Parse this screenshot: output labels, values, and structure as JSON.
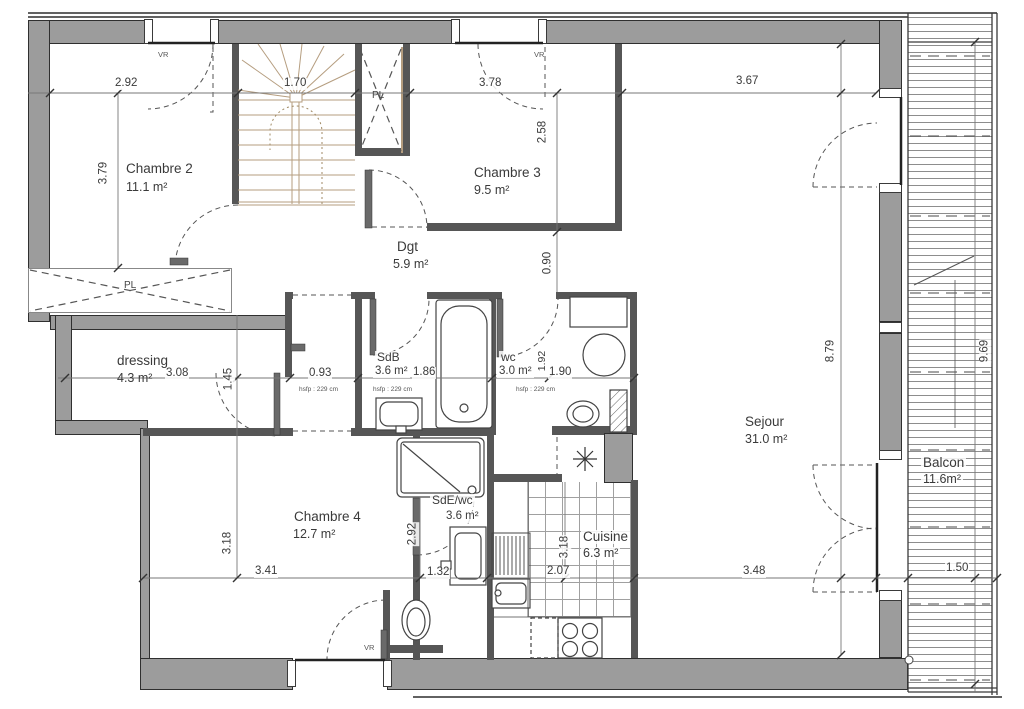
{
  "rooms": {
    "chambre2": {
      "name": "Chambre 2",
      "area": "11.1 m²"
    },
    "chambre3": {
      "name": "Chambre 3",
      "area": "9.5 m²"
    },
    "dgt": {
      "name": "Dgt",
      "area": "5.9 m²"
    },
    "dressing": {
      "name": "dressing",
      "area": "4.3 m²"
    },
    "sdb": {
      "name": "SdB",
      "area": "3.6 m²"
    },
    "wc": {
      "name": "wc",
      "area": "3.0 m²"
    },
    "chambre4": {
      "name": "Chambre 4",
      "area": "12.7 m²"
    },
    "sde": {
      "name": "SdE/wc",
      "area": "3.6 m²"
    },
    "cuisine": {
      "name": "Cuisine",
      "area": "6.3 m²"
    },
    "sejour": {
      "name": "Sejour",
      "area": "31.0 m²"
    },
    "balcon": {
      "name": "Balcon",
      "area": "11.6m²"
    }
  },
  "dims": {
    "chambre2_w": "2.92",
    "stairs_w": "1.70",
    "chambre3_w": "3.78",
    "sejour_w_top": "3.67",
    "chambre2_h": "3.79",
    "chambre3_h": "2.58",
    "dgt_h": "0.90",
    "dressing_w": "3.08",
    "hall_w": "0.93",
    "sdb_w": "1.86",
    "wc_w": "1.90",
    "wc_h": "1.92",
    "dressing_h": "1.45",
    "chambre4_h": "3.18",
    "chambre4_w": "3.41",
    "sde_h": "2.92",
    "sde_w": "1.32",
    "cuisine_w": "2.07",
    "cuisine_h": "3.18",
    "sejour_w": "3.48",
    "sejour_h": "8.79",
    "balcon_w": "1.50",
    "balcon_h": "9.69"
  },
  "notes": {
    "ceiling_hall": "hsfp : 229 cm",
    "ceiling_sdb": "hsfp : 229 cm",
    "ceiling_wc": "hsfp : 229 cm",
    "vr_top_left": "VR",
    "vr_top_mid": "VR",
    "vr_bottom": "VR",
    "pl_closet_wide": "PL",
    "pl_closet_tall": "PL"
  }
}
